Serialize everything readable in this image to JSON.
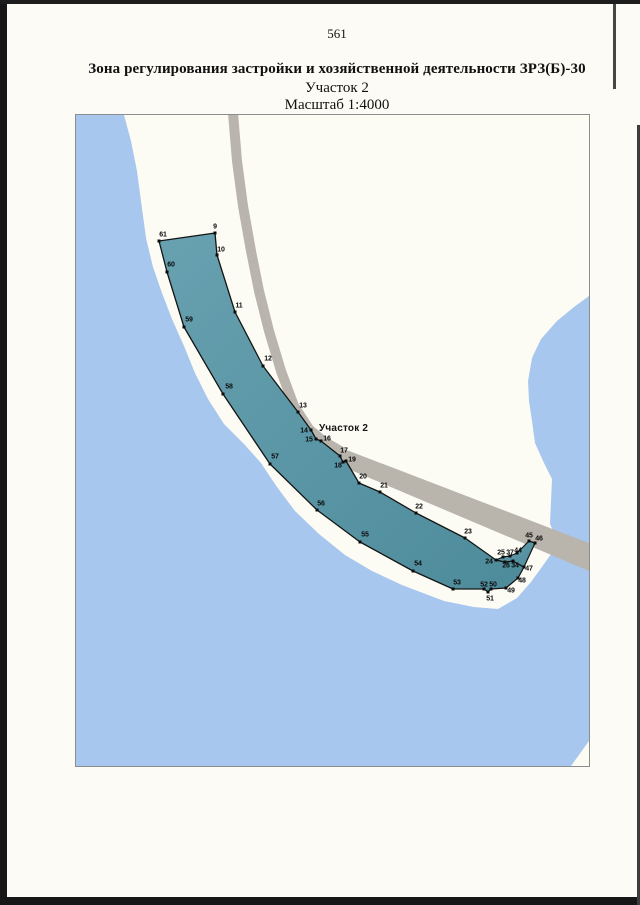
{
  "page": {
    "number": "561"
  },
  "header": {
    "title": "Зона регулирования застройки и хозяйственной деятельности ЗРЗ(Б)-30",
    "subtitle": "Участок 2",
    "scale": "Масштаб 1:4000"
  },
  "map": {
    "area_label": "Участок 2",
    "colors": {
      "water": "#a8c7ef",
      "land": "#fdfcf4",
      "road": "#b9b5ad",
      "zone_top": "#68a1b0",
      "zone_bottom": "#4d8b9b",
      "outline": "#141414"
    },
    "vertices": [
      {
        "n": "9",
        "lx": 214,
        "ly": 225,
        "mx": 214,
        "my": 232
      },
      {
        "n": "10",
        "lx": 220,
        "ly": 248,
        "mx": 216,
        "my": 254
      },
      {
        "n": "11",
        "lx": 238,
        "ly": 304,
        "mx": 234,
        "my": 311
      },
      {
        "n": "12",
        "lx": 267,
        "ly": 357,
        "mx": 262,
        "my": 365
      },
      {
        "n": "13",
        "lx": 302,
        "ly": 404,
        "mx": 297,
        "my": 411
      },
      {
        "n": "14",
        "lx": 303,
        "ly": 429,
        "mx": 310,
        "my": 429
      },
      {
        "n": "15",
        "lx": 308,
        "ly": 438,
        "mx": 315,
        "my": 438
      },
      {
        "n": "16",
        "lx": 326,
        "ly": 437,
        "mx": 320,
        "my": 440
      },
      {
        "n": "17",
        "lx": 343,
        "ly": 449,
        "mx": 339,
        "my": 455
      },
      {
        "n": "18",
        "lx": 337,
        "ly": 464,
        "mx": 342,
        "my": 461
      },
      {
        "n": "19",
        "lx": 351,
        "ly": 458,
        "mx": 345,
        "my": 460
      },
      {
        "n": "20",
        "lx": 362,
        "ly": 475,
        "mx": 358,
        "my": 482
      },
      {
        "n": "21",
        "lx": 383,
        "ly": 484,
        "mx": 379,
        "my": 491
      },
      {
        "n": "22",
        "lx": 418,
        "ly": 505,
        "mx": 415,
        "my": 512
      },
      {
        "n": "23",
        "lx": 467,
        "ly": 530,
        "mx": 464,
        "my": 537
      },
      {
        "n": "24",
        "lx": 488,
        "ly": 560,
        "mx": 495,
        "my": 559
      },
      {
        "n": "25",
        "lx": 500,
        "ly": 551,
        "mx": 502,
        "my": 556
      },
      {
        "n": "37",
        "lx": 509,
        "ly": 551,
        "mx": 509,
        "my": 555
      },
      {
        "n": "44",
        "lx": 517,
        "ly": 549,
        "mx": 516,
        "my": 552
      },
      {
        "n": "45",
        "lx": 528,
        "ly": 534,
        "mx": 528,
        "my": 540
      },
      {
        "n": "46",
        "lx": 538,
        "ly": 537,
        "mx": 534,
        "my": 542
      },
      {
        "n": "26",
        "lx": 505,
        "ly": 564,
        "mx": 504,
        "my": 561
      },
      {
        "n": "34",
        "lx": 514,
        "ly": 564,
        "mx": 512,
        "my": 560
      },
      {
        "n": "47",
        "lx": 528,
        "ly": 567,
        "mx": 523,
        "my": 566
      },
      {
        "n": "48",
        "lx": 521,
        "ly": 579,
        "mx": 517,
        "my": 577
      },
      {
        "n": "49",
        "lx": 510,
        "ly": 589,
        "mx": 505,
        "my": 587
      },
      {
        "n": "50",
        "lx": 492,
        "ly": 583,
        "mx": 490,
        "my": 588
      },
      {
        "n": "52",
        "lx": 483,
        "ly": 583,
        "mx": 483,
        "my": 588
      },
      {
        "n": "51",
        "lx": 489,
        "ly": 597,
        "mx": 487,
        "my": 591
      },
      {
        "n": "53",
        "lx": 456,
        "ly": 581,
        "mx": 452,
        "my": 588
      },
      {
        "n": "54",
        "lx": 417,
        "ly": 562,
        "mx": 412,
        "my": 570
      },
      {
        "n": "55",
        "lx": 364,
        "ly": 533,
        "mx": 359,
        "my": 541
      },
      {
        "n": "56",
        "lx": 320,
        "ly": 502,
        "mx": 316,
        "my": 509
      },
      {
        "n": "57",
        "lx": 274,
        "ly": 455,
        "mx": 269,
        "my": 463
      },
      {
        "n": "58",
        "lx": 228,
        "ly": 385,
        "mx": 222,
        "my": 393
      },
      {
        "n": "59",
        "lx": 188,
        "ly": 318,
        "mx": 183,
        "my": 326
      },
      {
        "n": "60",
        "lx": 170,
        "ly": 263,
        "mx": 166,
        "my": 271
      },
      {
        "n": "61",
        "lx": 162,
        "ly": 233,
        "mx": 158,
        "my": 240
      }
    ]
  }
}
